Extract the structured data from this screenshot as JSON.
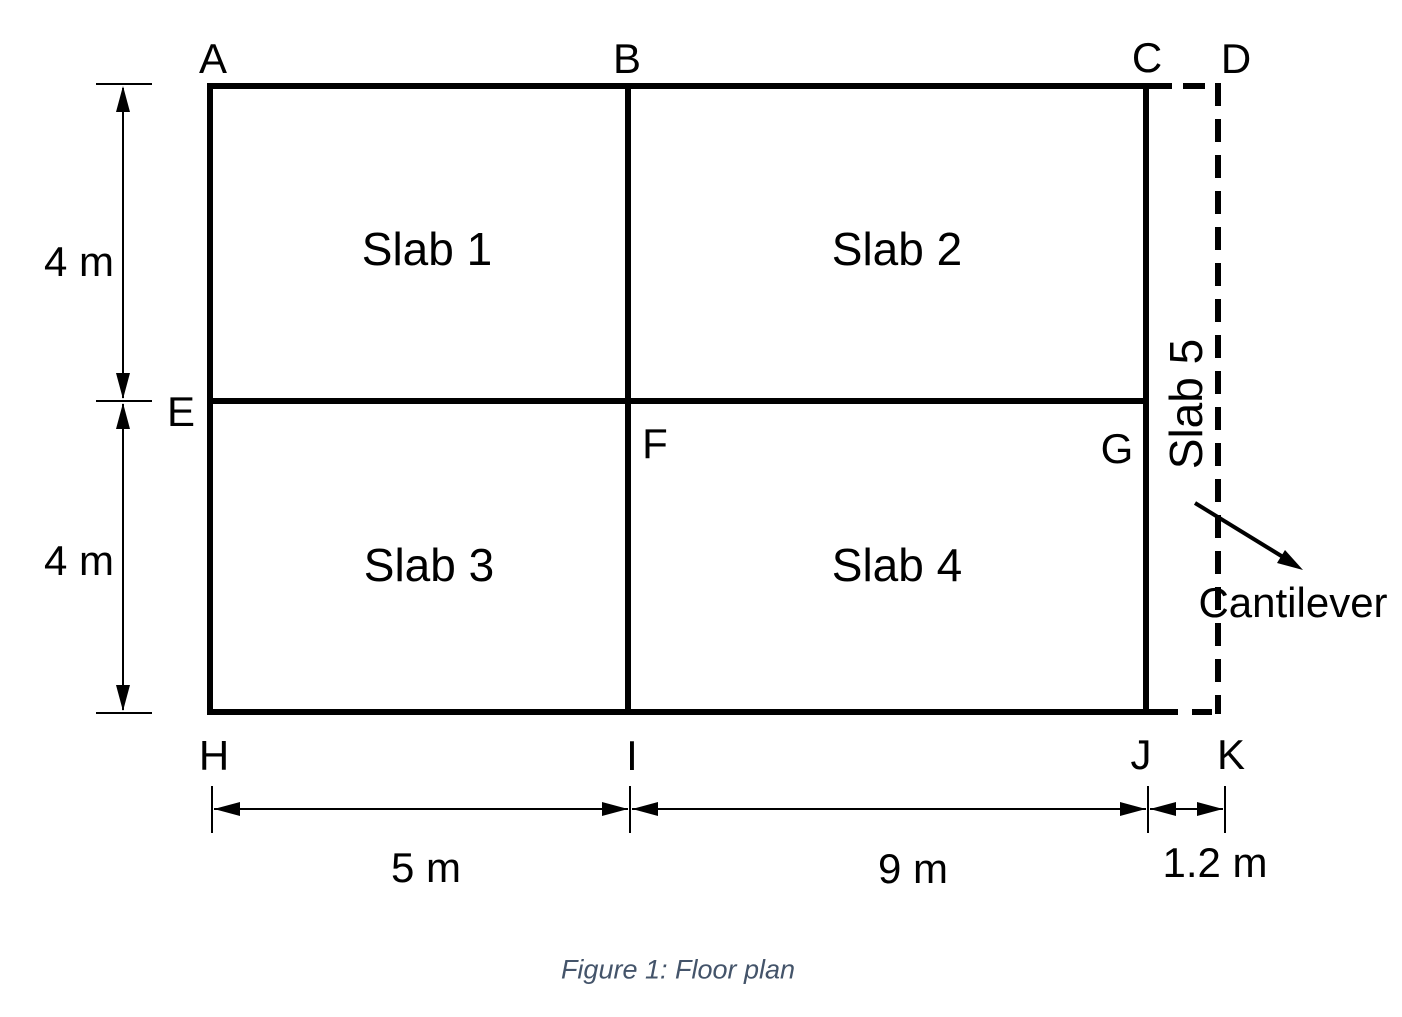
{
  "diagram": {
    "points": {
      "a": "A",
      "b": "B",
      "c": "C",
      "d": "D",
      "e": "E",
      "f": "F",
      "g": "G",
      "h": "H",
      "i": "I",
      "j": "J",
      "k": "K"
    },
    "slabs": {
      "slab1": "Slab 1",
      "slab2": "Slab 2",
      "slab3": "Slab 3",
      "slab4": "Slab 4",
      "slab5": "Slab 5"
    },
    "dimensions": {
      "left_upper": "4 m",
      "left_lower": "4 m",
      "bottom_left": "5 m",
      "bottom_center": "9 m",
      "bottom_right": "1.2 m"
    },
    "annotations": {
      "cantilever": "Cantilever"
    },
    "caption": "Figure 1: Floor plan",
    "colors": {
      "line": "#000000",
      "caption_text": "#44546A",
      "background": "#ffffff"
    }
  }
}
